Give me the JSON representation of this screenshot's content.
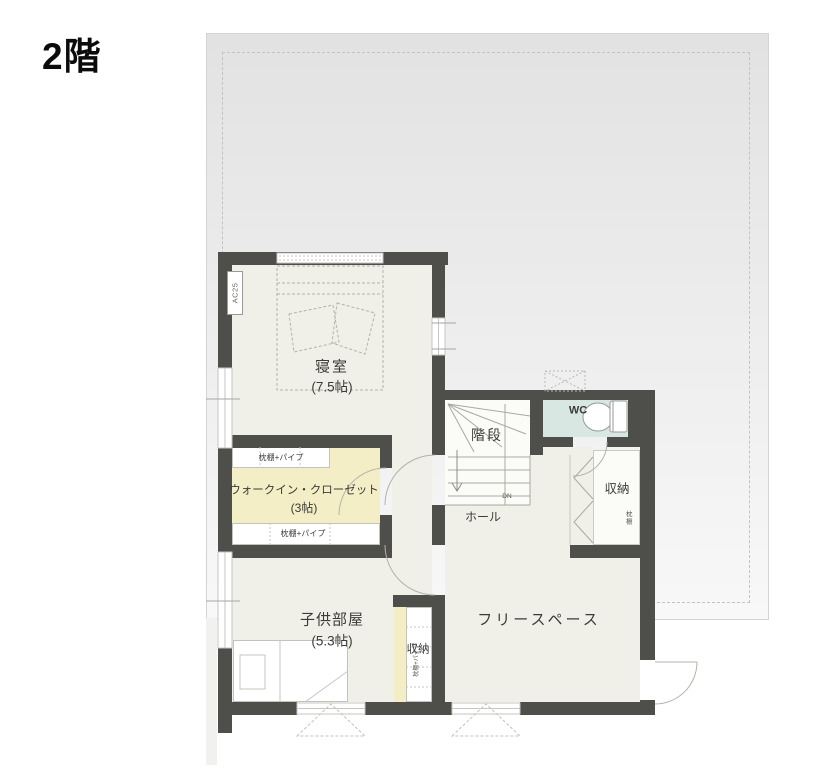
{
  "title": "2階",
  "colors": {
    "wall": "#4e4e4a",
    "floor": "#f0efe8",
    "wic": "#f3eec6",
    "wc": "#d9e7e3",
    "roof_top": "#e2e2e2",
    "roof_bottom": "#f8f8f8",
    "line": "#a6a6a0",
    "line_light": "#c6c6c2",
    "text": "#3b3b38"
  },
  "labels": {
    "bedroom_name": "寝室",
    "bedroom_size": "(7.5帖)",
    "wic_name": "ウォークイン・クローゼット",
    "wic_size": "(3帖)",
    "wic_shelf_top": "枕棚+パイプ",
    "wic_shelf_bottom": "枕棚+パイプ",
    "stairs": "階段",
    "dn": "DN",
    "wc": "WC",
    "storage_upper": "収納",
    "storage_upper_note": "枕棚",
    "hall": "ホール",
    "kids_name": "子供部屋",
    "kids_size": "(5.3帖)",
    "storage_kids": "収納",
    "storage_kids_note": "枕棚+パイプ",
    "free_space": "フリースペース",
    "ac": "AC25"
  }
}
